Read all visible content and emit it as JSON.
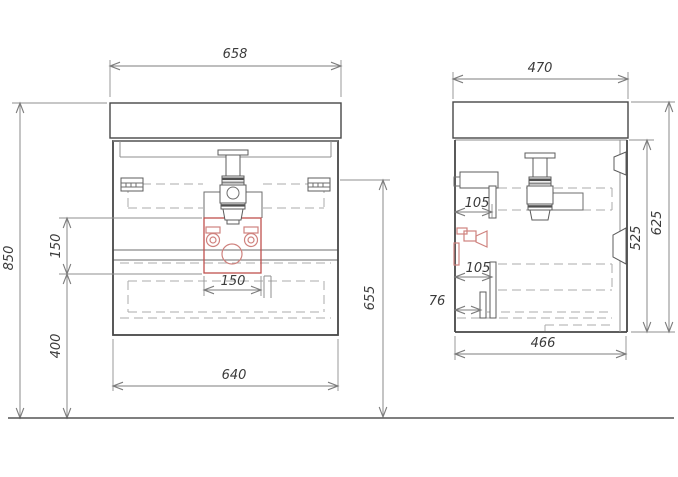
{
  "figure": {
    "type": "technical-drawing",
    "subject": "wall-hung vanity cabinet with washbasin, siphon and shut-off valves; front and side orthographic views over a floor line",
    "views": {
      "front": {
        "dimensions": {
          "basin_width": "658",
          "overall_height": "850",
          "cutout_height": "150",
          "cutout_to_floor": "400",
          "cabinet_width": "640",
          "cabinet_to_floor_height": "655",
          "cutout_width": "150"
        }
      },
      "side": {
        "dimensions": {
          "basin_depth": "470",
          "upper_pipe_offset": "105",
          "lower_pipe_offset": "105",
          "drain_offset": "76",
          "cabinet_depth": "466",
          "cabinet_height": "525",
          "overall_depth_height": "625"
        }
      }
    },
    "colors": {
      "outline": "#474747",
      "dimension_lines": "#7d7d7d",
      "hidden_lines": "#ababab",
      "highlight_red": "#c0504d",
      "highlight_pink": "#cf827e"
    }
  }
}
